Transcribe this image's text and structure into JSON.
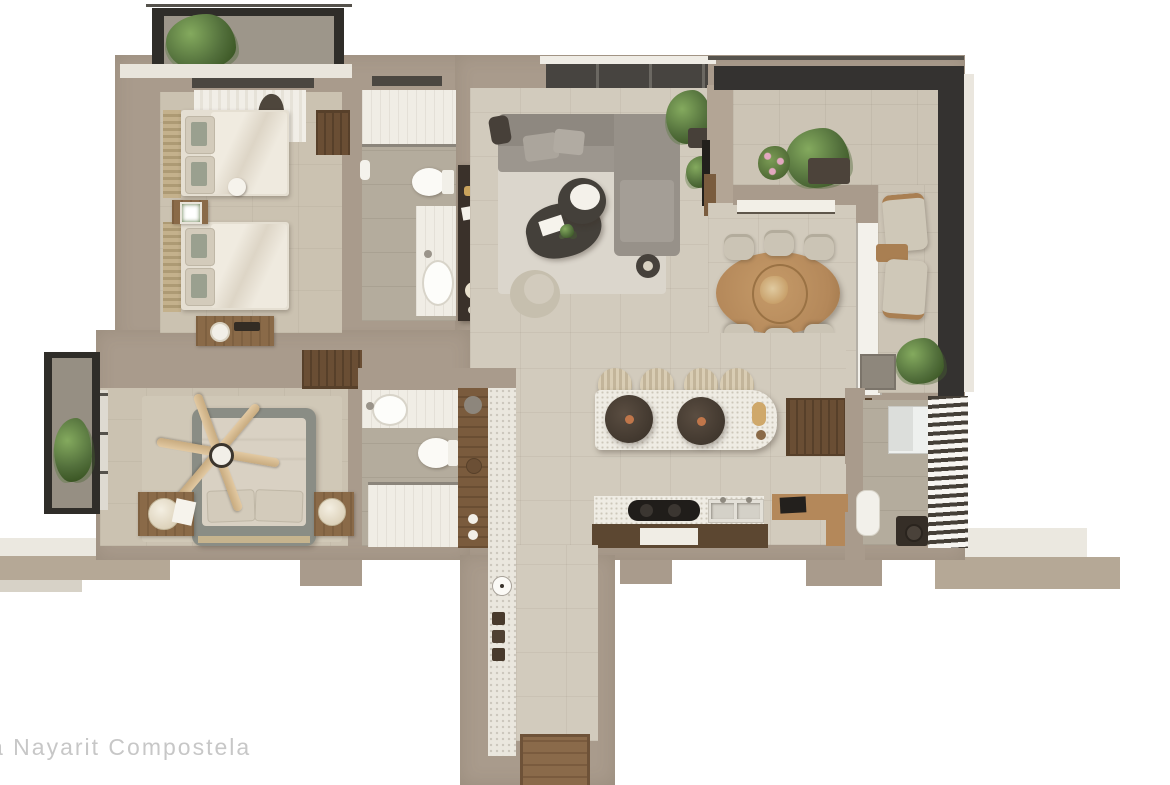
{
  "scene": {
    "description": "Top-down 3D rendered floor plan of a two-bedroom apartment on a white background",
    "watermark": "a Nayarit Compostela"
  },
  "legend": {
    "rooms": [
      {
        "id": "bedroom-2",
        "label": "Bedroom 2",
        "items": [
          "twin bed",
          "twin bed",
          "nightstand with lamp",
          "desk",
          "wardrobe shelf",
          "sheer curtain",
          "robe"
        ]
      },
      {
        "id": "bedroom-2-balcony",
        "label": "Bedroom 2 Balcony",
        "items": [
          "potted plant",
          "dark metal railing"
        ]
      },
      {
        "id": "bathroom-2",
        "label": "Bathroom 2",
        "items": [
          "shower",
          "toilet",
          "vanity with sink",
          "towel ring",
          "dark console with decor"
        ]
      },
      {
        "id": "living-room",
        "label": "Living Room",
        "items": [
          "L-shaped sectional sofa",
          "throw pillows",
          "organic coffee tables",
          "area rug",
          "accent chair",
          "side tables",
          "potted plants",
          "TV wall"
        ]
      },
      {
        "id": "dining-area",
        "label": "Dining Area",
        "items": [
          "oval wood dining table",
          "six chairs",
          "centerpiece",
          "buffet shelf"
        ]
      },
      {
        "id": "terrace",
        "label": "Terrace",
        "items": [
          "dark glass railing",
          "monstera plant",
          "flower pot",
          "planter box",
          "two lounge chairs",
          "side table",
          "corner plant"
        ]
      },
      {
        "id": "kitchen",
        "label": "Kitchen",
        "items": [
          "island with two pendant lamps",
          "four bar stools",
          "cooktop",
          "double sink",
          "wood base cabinets",
          "tall pantry cabinet",
          "L-shaped desk with laptop"
        ]
      },
      {
        "id": "master-bedroom",
        "label": "Master Bedroom",
        "items": [
          "double bed",
          "ceiling fan",
          "two nightstands with round lamps",
          "area rug",
          "closet shelves",
          "window"
        ]
      },
      {
        "id": "master-bedroom-balcony",
        "label": "Master Bedroom Balcony",
        "items": [
          "potted plant",
          "dark metal frame"
        ]
      },
      {
        "id": "master-bathroom",
        "label": "Master Bathroom",
        "items": [
          "vanity with sink",
          "toilet",
          "shower",
          "wood storage wall",
          "pebbled accent wall"
        ]
      },
      {
        "id": "entry-hallway",
        "label": "Entry Hallway",
        "items": [
          "wall clock",
          "three wall hooks",
          "wood entry mat",
          "pebbled accent wall"
        ]
      },
      {
        "id": "laundry-utility",
        "label": "Laundry / Utility Area",
        "items": [
          "white cabinet",
          "louvered slat screen",
          "water heater",
          "dark speaker box"
        ]
      }
    ]
  },
  "palette": {
    "background": "#ffffff",
    "wall": "#a99b8c",
    "floor_tile": "#d2cbbd",
    "bedroom_floor": "#cbc2b1",
    "bathroom_floor": "#b4ac9d",
    "white_tile": "#f0ede5",
    "rug": "#dbd6cc",
    "sofa": "#97918a",
    "dark_furniture": "#44403a",
    "wood": "#8a6a48",
    "light_wood": "#b4885a",
    "dark_wood": "#5c4731",
    "bed_linen": "#e5dfd2",
    "master_bed_frame": "#8a8d85",
    "railing": "#343230",
    "plant": "#53703c",
    "ledge": "#b5a896",
    "watermark_text": "#c7c7c7"
  }
}
